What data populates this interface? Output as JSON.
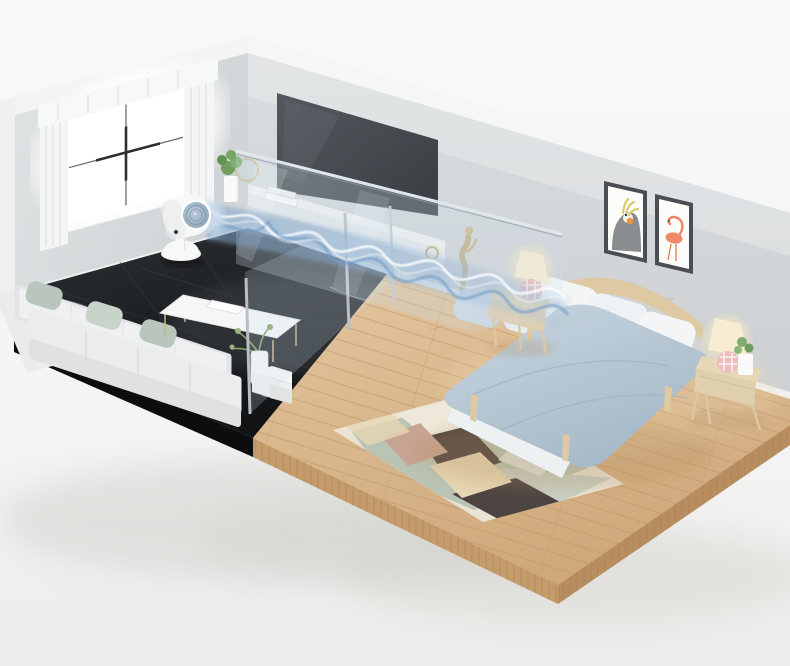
{
  "scene": {
    "kind": "isometric-room-cutaway-render",
    "rooms": [
      "living-room",
      "bedroom"
    ],
    "product": "white-pedestal-air-circulator-fan",
    "effect": "blue-airflow-stream-crossing-both-rooms-through-glass-partition"
  },
  "colors": {
    "background": "#f6f7f7",
    "wall": "#d4d7d9",
    "wallLight": "#dde0e2",
    "trim": "#f2f3f3",
    "baseboard": "#f0f1f1",
    "wallEdge": "#eff0f0",
    "marble": "#232629",
    "marbleEdge": "#0c0d0e",
    "marbleVein": "#e8eaec",
    "wood": "#dcbd92",
    "woodEdgeFront": "#c49b6b",
    "woodEdgeRight": "#b88e60",
    "plankLine": "#b8905f",
    "sofa": "#eaeced",
    "sofaBack": "#e2e4e6",
    "sofaFront": "#dfe1e3",
    "pillowSage": "#b9c6bd",
    "tv": "#45494e",
    "console": "#f2f3f2",
    "consoleFront": "#e7e9e9",
    "glassTint": "#cddeeb",
    "glassFrame": "#dfe7ec",
    "air": "#6d9ac8",
    "airMid": "#a9c4de",
    "airLight": "#ffffff",
    "fanBody": "#f7f8f8",
    "fanFace": "#93abc0",
    "fanRing": "#7e97ab",
    "duvet": "#b9c9d6",
    "sheet": "#eef1f2",
    "pillowWhite": "#f3f5f6",
    "pillowBlue": "#ccd8e2",
    "bedFrame": "#dfc9a3",
    "nightstand": "#e8d7b6",
    "nightstandFront": "#e0cfae",
    "lampShade": "#f8edd3",
    "lampBase": "#eebcba",
    "rugBase": "#eae3d4",
    "rugSage": "#b6c2b2",
    "rugSageLight": "#c8cfc2",
    "rugBrown": "#4d4441",
    "rugPink": "#c8a493",
    "rugBeige": "#e6d6b2",
    "rugCream": "#efe8da",
    "plantGreen": "#6f9d5d",
    "artFrame": "#4b4e52",
    "artPaper": "#fbfbfa",
    "cockatielGray": "#8a8d8f",
    "crestYellow": "#dcc75f",
    "cheekOrange": "#ef923d",
    "flamingoPink": "#ef8a68",
    "sculptureGold": "#c0ad7e",
    "curtain": "#f4f5f5",
    "windowGlow": "#ffffff",
    "muntin": "#6b6e70",
    "muntinDark": "#2c2d2e"
  }
}
